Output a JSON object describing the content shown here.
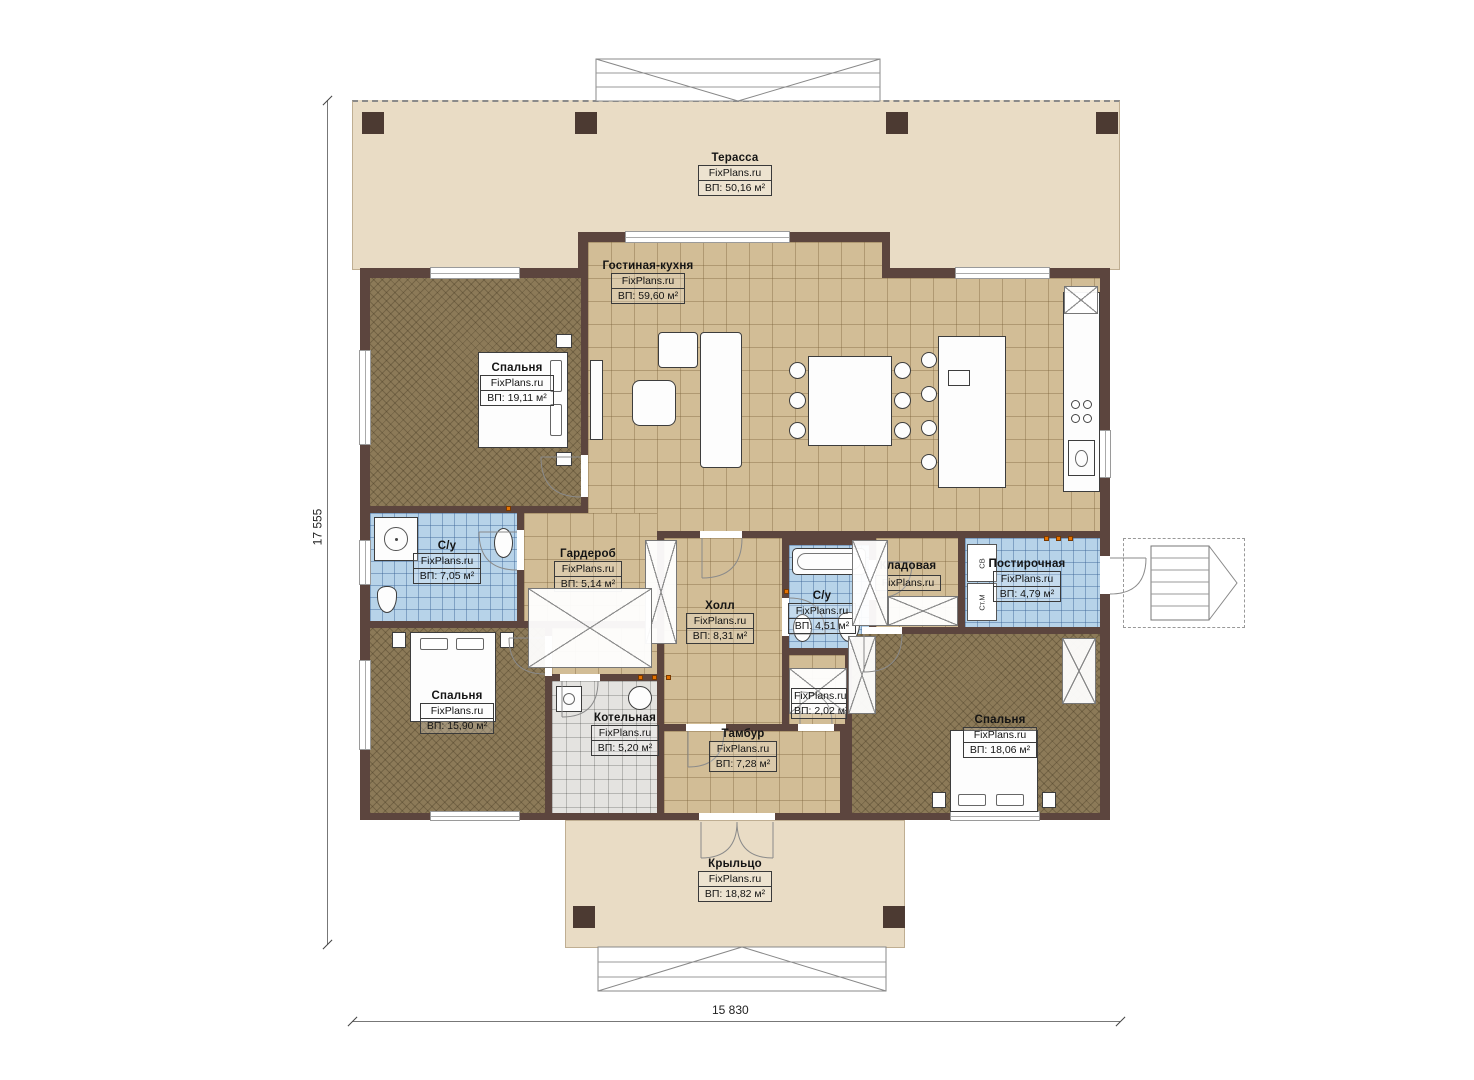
{
  "dims": {
    "height": "17 555",
    "width": "15 830"
  },
  "rooms": {
    "terrace": {
      "name": "Терасса",
      "site": "FixPlans.ru",
      "area": "ВП: 50,16 м²"
    },
    "living": {
      "name": "Гостиная-кухня",
      "site": "FixPlans.ru",
      "area": "ВП: 59,60 м²"
    },
    "bedroom_tl": {
      "name": "Спальня",
      "site": "FixPlans.ru",
      "area": "ВП: 19,11 м²"
    },
    "bath_left": {
      "name": "С/у",
      "site": "FixPlans.ru",
      "area": "ВП: 7,05 м²"
    },
    "wardrobe": {
      "name": "Гардероб",
      "site": "FixPlans.ru",
      "area": "ВП: 5,14 м²"
    },
    "hall": {
      "name": "Холл",
      "site": "FixPlans.ru",
      "area": "ВП: 8,31 м²"
    },
    "bath_mid": {
      "name": "С/у",
      "site": "FixPlans.ru",
      "area": "ВП: 4,51 м²"
    },
    "pantry": {
      "name": "Кладовая",
      "site": "FixPlans.ru"
    },
    "laundry": {
      "name": "Постирочная",
      "site": "FixPlans.ru",
      "area": "ВП: 4,79 м²"
    },
    "bedroom_bl": {
      "name": "Спальня",
      "site": "FixPlans.ru",
      "area": "ВП: 15,90 м²"
    },
    "boiler": {
      "name": "Котельная",
      "site": "FixPlans.ru",
      "area": "ВП: 5,20 м²"
    },
    "vestibule": {
      "name": "Тамбур",
      "site": "FixPlans.ru",
      "area": "ВП: 7,28 м²"
    },
    "closet_small": {
      "site": "FixPlans.ru",
      "area": "ВП: 2,02 м²"
    },
    "bedroom_br": {
      "name": "Спальня",
      "site": "FixPlans.ru",
      "area": "ВП: 18,06 м²"
    },
    "porch": {
      "name": "Крыльцо",
      "site": "FixPlans.ru",
      "area": "ВП: 18,82 м²"
    }
  },
  "appliances": {
    "dryer": "СВ",
    "washer": "Ст.М"
  },
  "colors": {
    "wall": "#5c453e",
    "terrace": "#e9dcc5",
    "tile": "#d2bd96",
    "wet": "#b7d3e9",
    "bedroom": "#8c7a58",
    "marker": "#e57200"
  }
}
